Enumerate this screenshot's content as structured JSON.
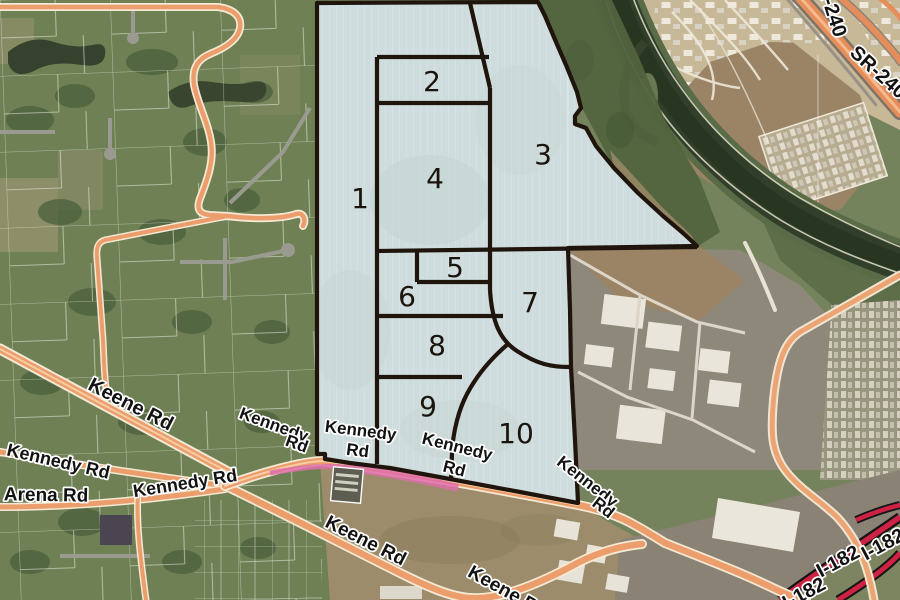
{
  "map": {
    "description": "Aerial planning map with numbered parcel overlay",
    "parcel_numbers": [
      "1",
      "2",
      "3",
      "4",
      "5",
      "6",
      "7",
      "8",
      "9",
      "10"
    ],
    "road_labels": [
      "Keene Rd",
      "Kennedy Rd",
      "Arena Rd",
      "Kennedy Rd",
      "Kennedy",
      "Rd",
      "Kennedy",
      "Rd",
      "Kennedy",
      "Rd",
      "Kennedy",
      "Rd",
      "Keene Rd",
      "Keene Rd"
    ],
    "highway_labels": [
      "SR-240",
      "SR-240",
      "I-182",
      "I-182",
      "I-182"
    ],
    "colors": {
      "parcel_overlay_fill": "#cfdcde",
      "parcel_boundary": "#1f150d",
      "road_orange": "#eb9d6b",
      "road_casing": "#f4e9d4",
      "highway_orange": "#e68e5b",
      "freeway_red": "#ce2244",
      "freeway_casing": "#141414",
      "pink_ribbon": "#df6fa9",
      "river": "#313f2a",
      "rural_green": "#6e8054",
      "industrial_gray": "#8e887a",
      "scrub_tan": "#9b8465"
    }
  }
}
